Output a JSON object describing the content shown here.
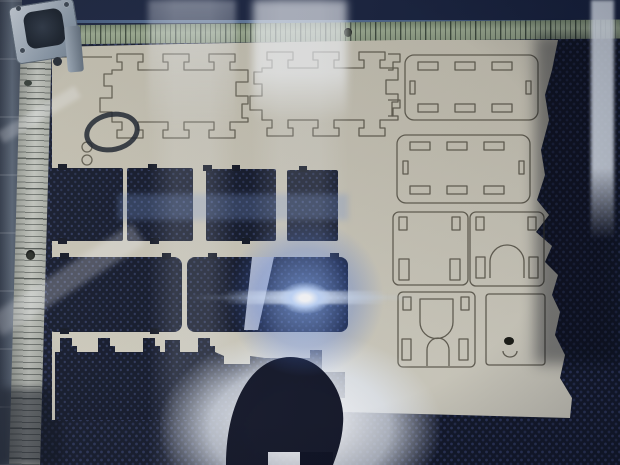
{
  "scene": {
    "type": "photograph",
    "subject": "Laser cutter in operation photographed through its glass lid: tan cardboard sheet with laser-cut part outlines on a dark honeycomb bed, bright blue laser flare, window reflections and the photographer's silhouette",
    "labels": {
      "bed": "dark blue honeycomb cutting bed",
      "frame_top": "machine frame top rail",
      "ruler_top": "horizontal ruler strip with fine tick marks",
      "ruler_top_hole": "mounting hole in top ruler",
      "rail_left": "machine frame left rail",
      "ruler_left": "vertical ruler strip with tick marks",
      "ruler_left_hole": "mounting hole in left ruler",
      "mirror_assembly": "laser mirror / head assembly in top-left corner",
      "cardboard": "tan cardboard sheet with torn right and bottom edges",
      "finger_panel_1": "laser-cut finger-jointed panel outline (left)",
      "finger_panel_2": "laser-cut finger-jointed panel outline (right)",
      "registration_circles": "two small cut circles",
      "slotted_panel_a": "rounded rectangular panel with slot cuts (top right)",
      "slotted_panel_b": "rounded rectangular panel with slot cuts (second right)",
      "square_panel_c": "small square panel with corner slots",
      "square_panel_d": "small square panel with dome cutout",
      "arch_panel_e": "panel with dome and arch cutouts",
      "plain_panel_f": "plain panel with small burned hole",
      "cutout_row1": "row of four rectangular cutouts showing honeycomb bed",
      "cutout_row2": "row of two large rounded cutouts showing honeycomb bed",
      "big_cutout": "large removed area with castellated finger-joint edge",
      "lifted_flap": "curled lifted cardboard flap catching light",
      "laser_flare": "bright blue-white flare from the cutting laser",
      "reflection_bands": "vertical light reflections on the glass lid",
      "right_reflection": "bright reflection strip at right edge",
      "photographer_silhouette": "dark reflected silhouette of the photographer's head",
      "bottom_glow": "bright diffuse reflection around the silhouette"
    }
  },
  "palette": {
    "bed_base": "#131828",
    "bed_dot": "#2d365a",
    "cardboard_light": "#d8d4c4",
    "cardboard_mid": "#c9c4b3",
    "cardboard_dark": "#c1bcab",
    "cut_line": "#4b4637",
    "frame_top": "#17203a",
    "ruler_top_green": "#8e9c80",
    "rail_left_grey": "#4a5462",
    "ruler_left_grey": "#b5b8ae",
    "metal_plate": "#aab4bf",
    "flare_core": "#ffffff",
    "flare_glow": "#5b8be8",
    "silhouette": "#0c1020",
    "reflection_white": "#f4f7fc"
  }
}
